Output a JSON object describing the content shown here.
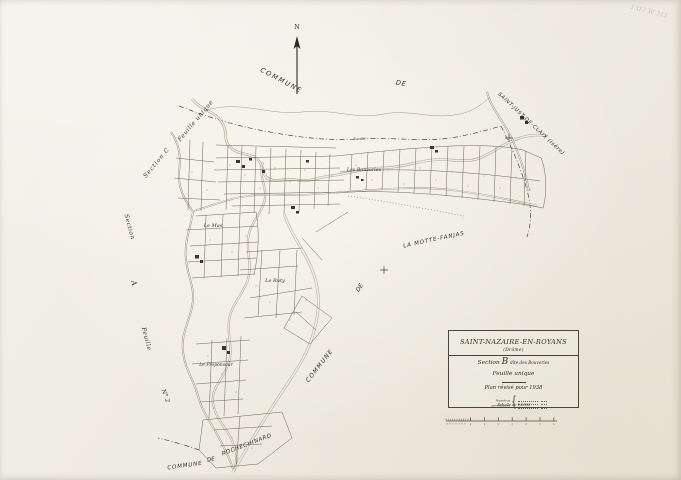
{
  "archive_note": "1317 W 312",
  "colors": {
    "paper": "#efece2",
    "ink": "#4f4a39"
  },
  "compass": {
    "north": "N"
  },
  "neighbors": {
    "north": {
      "commune": "COMMUNE",
      "de": "DE",
      "name": "SAINT-JUST-DE-CLAIX (Isère)"
    },
    "east": {
      "commune": "COMMUNE",
      "de": "DE",
      "name": "LA MOTTE-FANJAS"
    },
    "south": {
      "commune": "COMMUNE",
      "de": "DE",
      "name": "ROCHECHINARD"
    }
  },
  "adjacent_sections": {
    "c": {
      "label": "Section C",
      "sheet": "Feuille unique"
    },
    "a": {
      "word_section": "Section",
      "letter": "A",
      "word_feuille": "Feuille",
      "number": "N° 2"
    }
  },
  "places": {
    "bouveries": "Les Bouveries",
    "mas": "Le Mas",
    "ruty": "Le Ruty",
    "proponsour": "Le Proponsour",
    "river": "Bourne"
  },
  "cartouche": {
    "commune": "SAINT-NAZAIRE-EN-ROYANS",
    "department": "(Drôme)",
    "section_word": "Section",
    "section_letter": "B",
    "section_name": "dite des Bouveries",
    "sheet": "Feuille unique",
    "revision": "Plan révisé pour 1938",
    "scale": "Échelle de 1/2500",
    "legend_label1": "Numéros",
    "legend_label2": "parcellaires"
  }
}
